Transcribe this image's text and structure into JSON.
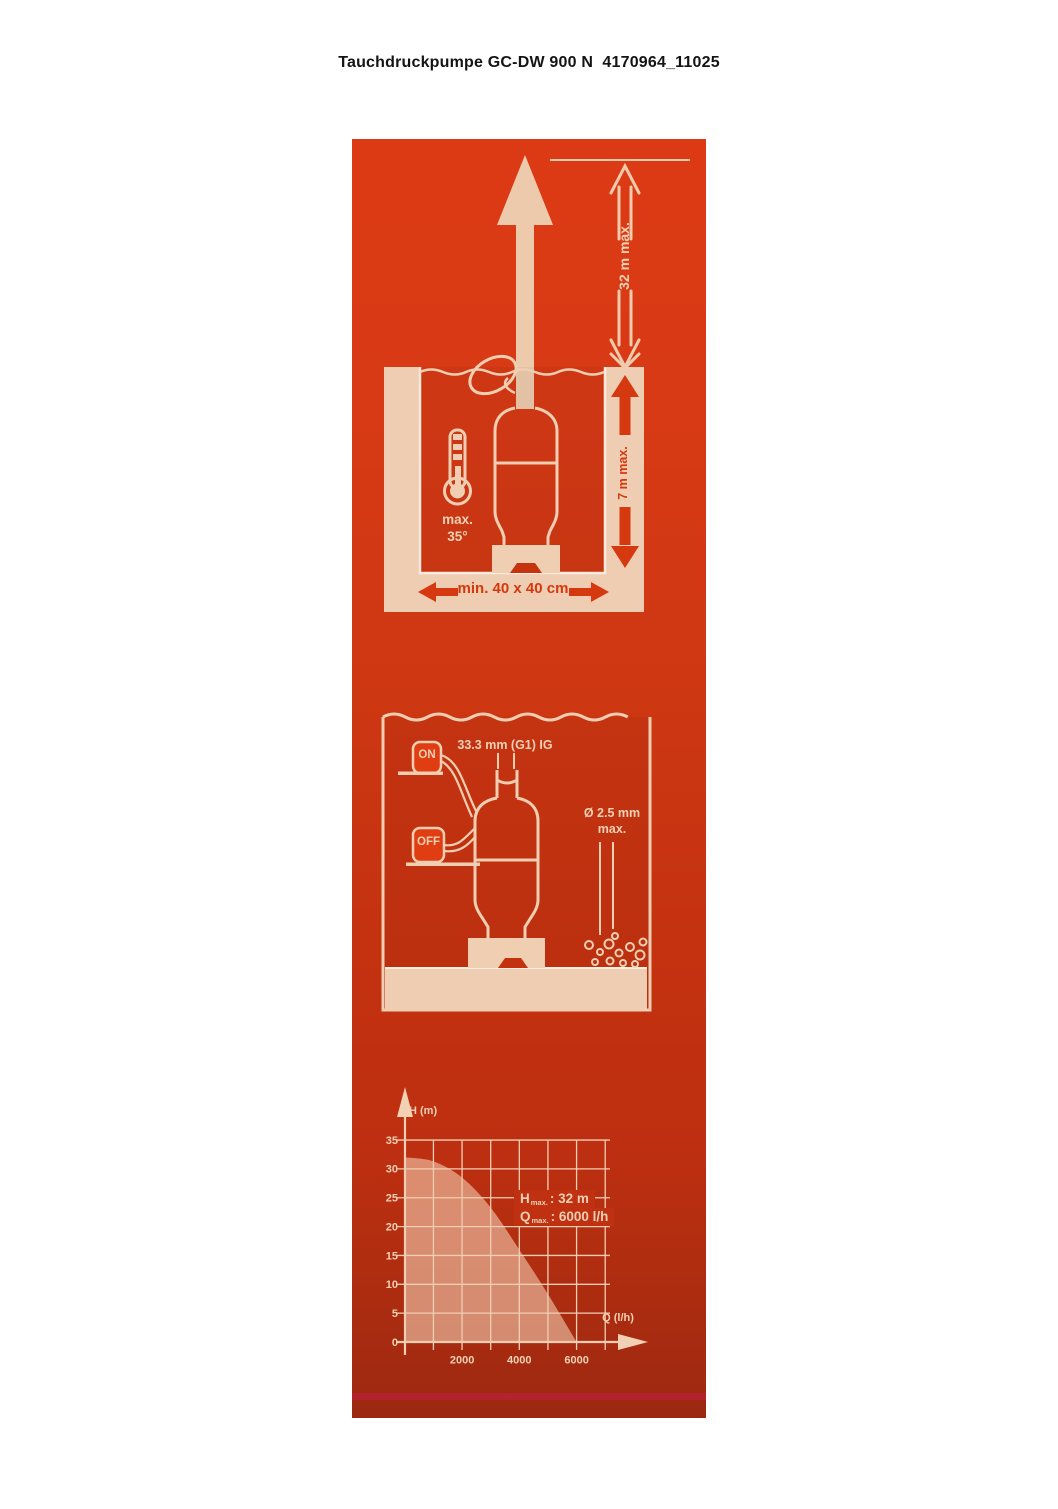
{
  "page": {
    "title": "Tauchdruckpumpe GC-DW 900 N  4170964_11025"
  },
  "colors": {
    "panel_red_top": "#DC3A14",
    "panel_red_bottom": "#9C2810",
    "cream": "#F0CEB2",
    "accent_strip": "#B3232E",
    "red_text": "#D6390F",
    "curve_fill": "#DD9B7D"
  },
  "installation": {
    "height_max": "32 m max.",
    "depth_max": "7 m max.",
    "pit_min": "min. 40 x 40 cm",
    "temp_max": "max.",
    "temp_value": "35°"
  },
  "operation": {
    "switch_on": "ON",
    "switch_off": "OFF",
    "connection": "33.3 mm (G1) IG",
    "particle_diameter": "Ø 2.5 mm",
    "particle_max": "max."
  },
  "chart_data": {
    "type": "area",
    "title": "",
    "xlabel": "Q (l/h)",
    "ylabel": "H (m)",
    "x": [
      0,
      1000,
      2000,
      3000,
      4000,
      5000,
      6000
    ],
    "y": [
      32,
      31.3,
      28.5,
      23.3,
      16,
      8.3,
      0
    ],
    "x_ticks": [
      2000,
      4000,
      6000
    ],
    "y_ticks": [
      35,
      30,
      25,
      20,
      15,
      10,
      5,
      0
    ],
    "x_grid_step": 1000,
    "x_grid_max": 7000,
    "y_grid_step": 5,
    "y_grid_max": 35,
    "xlim": [
      0,
      7000
    ],
    "ylim": [
      0,
      35
    ],
    "grid": true,
    "annotations": [
      {
        "symbol": "H",
        "sub": "max.",
        "value": ": 32 m"
      },
      {
        "symbol": "Q",
        "sub": "max.",
        "value": ": 6000 l/h"
      }
    ]
  }
}
